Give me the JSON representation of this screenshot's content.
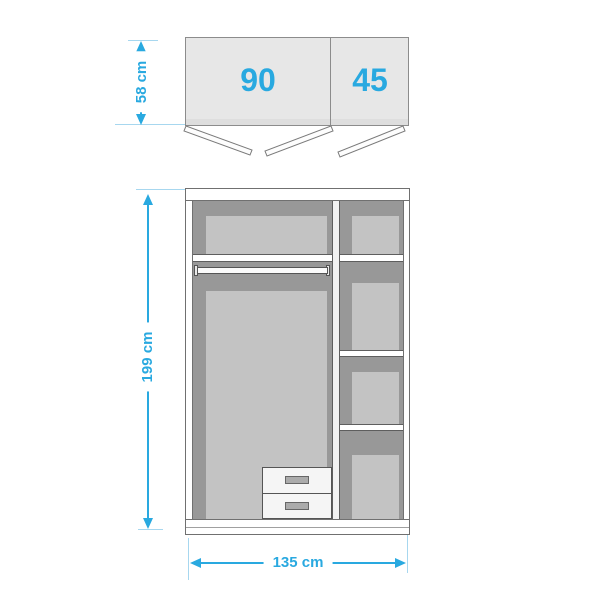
{
  "title": "Wardrobe dimension diagram",
  "accent_color": "#29A9E0",
  "top_view": {
    "depth": "58 cm",
    "sections": [
      "90",
      "45"
    ]
  },
  "front_view": {
    "height": "199 cm",
    "width": "135 cm"
  }
}
